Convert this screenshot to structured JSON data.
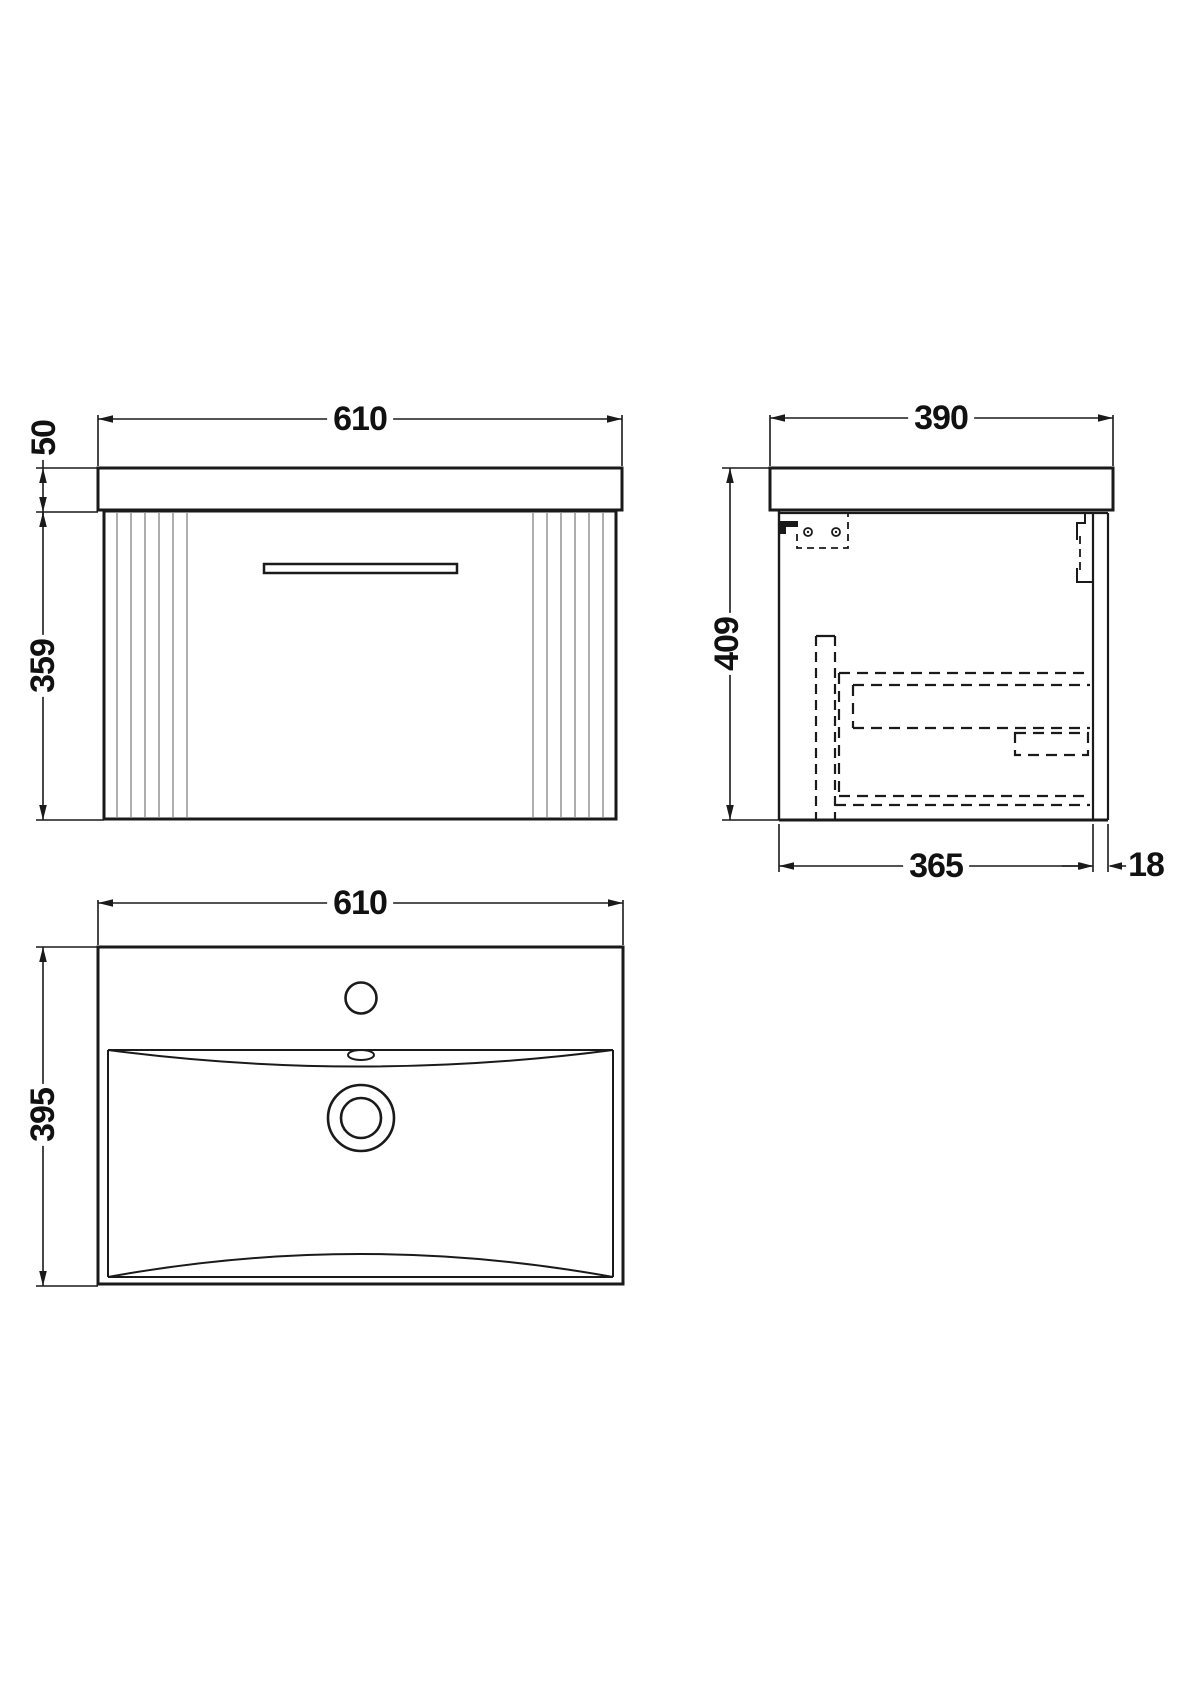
{
  "drawing": {
    "background": "#ffffff",
    "line_color": "#1a1a1a",
    "flute_line_color": "#9a9a9a",
    "views": {
      "front": {
        "width_mm": "610",
        "worktop_height_mm": "50",
        "cabinet_height_mm": "359"
      },
      "side": {
        "depth_mm": "390",
        "height_mm": "409",
        "internal_depth_mm": "365",
        "back_panel_mm": "18"
      },
      "top": {
        "width_mm": "610",
        "depth_mm": "395"
      }
    }
  }
}
